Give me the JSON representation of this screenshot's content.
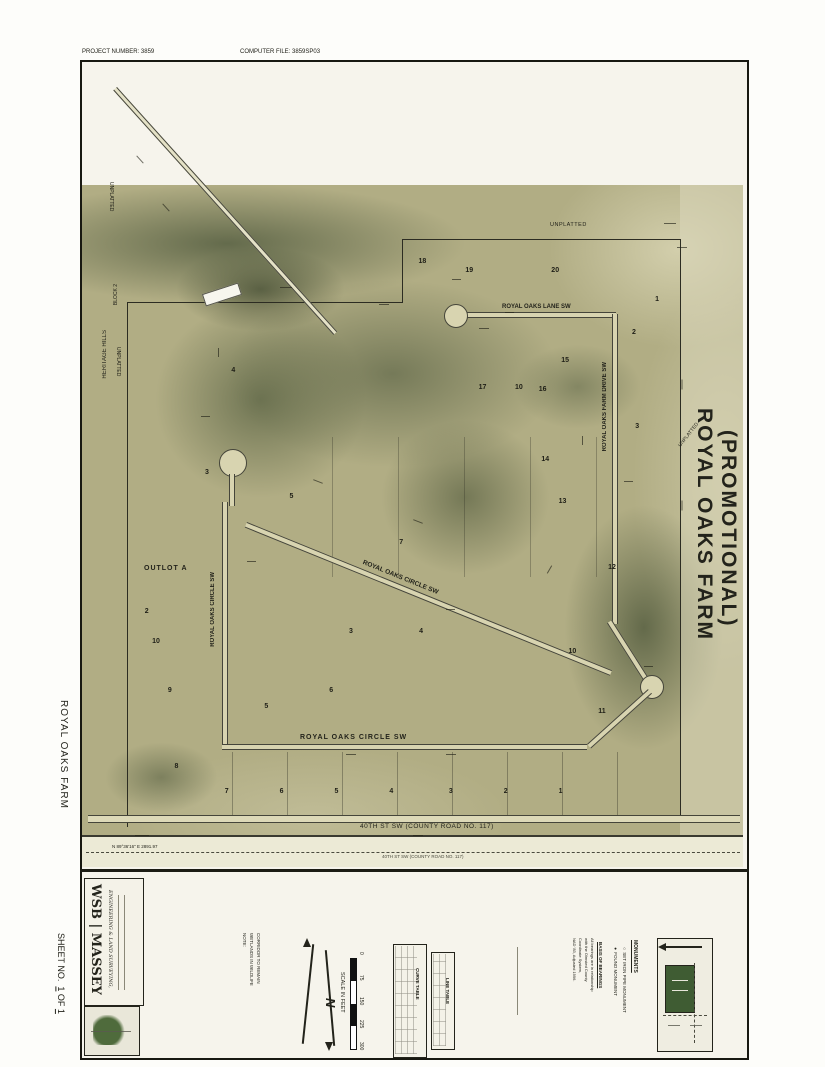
{
  "header": {
    "project_label": "PROJECT NUMBER",
    "project_value": "3859",
    "file_label": "COMPUTER FILE",
    "file_value": "3859SP03"
  },
  "titles": {
    "right_line1": "ROYAL OAKS FARM",
    "right_line2": "(PROMOTIONAL)",
    "left_margin": "ROYAL OAKS FARM",
    "sheet_label": "SHEET NO.",
    "sheet_num": "1",
    "sheet_of": "OF",
    "sheet_total": "1"
  },
  "firm": {
    "name": "WSB | MASSEY",
    "tagline": "ENGINEERING & LAND SURVEYING,"
  },
  "note": {
    "lines": [
      "NOTE:",
      "WETLANDS IN WILDLIFE",
      "CORRIDOR TO REMAIN"
    ]
  },
  "scale": {
    "label": "SCALE IN FEET",
    "ticks": [
      "0",
      "75",
      "150",
      "225",
      "300"
    ],
    "north_letter": "N"
  },
  "tables": {
    "curve_title": "CURVE TABLE",
    "line_title": "LINE TABLE"
  },
  "legend": {
    "title": "MONUMENTS",
    "items": [
      {
        "symbol": "○",
        "label": "SET IRON PIPE MONUMENT"
      },
      {
        "symbol": "●",
        "label": "FOUND MONUMENT"
      }
    ],
    "bearings_title": "BASIS OF BEARINGS",
    "bearings_lines": [
      "All bearings are in relationship",
      "with the Olmsted County",
      "Coordinate System,",
      "NAD '83, Adjusted 1996."
    ]
  },
  "map": {
    "streets": {
      "lane": "ROYAL OAKS LANE SW",
      "circle": "ROYAL OAKS CIRCLE SW",
      "farm_drive": "ROYAL OAKS FARM DRIVE SW",
      "county_road": "40TH ST SW (COUNTY ROAD NO. 117)"
    },
    "labels": {
      "outlot": "OUTLOT A",
      "unplatted": "UNPLATTED",
      "heritage": "HERITAGE HILLS",
      "block2": "BLOCK 2"
    },
    "bearing_bottom": "N 89°36'16\" E   2891.97",
    "lots": [
      {
        "n": "18",
        "x": 50.9,
        "y": 24.3
      },
      {
        "n": "19",
        "x": 58.0,
        "y": 25.5
      },
      {
        "n": "20",
        "x": 71.0,
        "y": 25.5
      },
      {
        "n": "1",
        "x": 86.7,
        "y": 29.1
      },
      {
        "n": "2",
        "x": 83.2,
        "y": 33.2
      },
      {
        "n": "15",
        "x": 72.5,
        "y": 36.6
      },
      {
        "n": "16",
        "x": 69.1,
        "y": 40.3
      },
      {
        "n": "10",
        "x": 65.5,
        "y": 40.0
      },
      {
        "n": "17",
        "x": 60.0,
        "y": 40.0
      },
      {
        "n": "3",
        "x": 83.7,
        "y": 44.9
      },
      {
        "n": "14",
        "x": 69.5,
        "y": 49.0
      },
      {
        "n": "4",
        "x": 22.6,
        "y": 37.9
      },
      {
        "n": "3",
        "x": 18.6,
        "y": 50.5
      },
      {
        "n": "5",
        "x": 31.4,
        "y": 53.6
      },
      {
        "n": "7",
        "x": 48.0,
        "y": 59.2
      },
      {
        "n": "13",
        "x": 72.1,
        "y": 54.2
      },
      {
        "n": "12",
        "x": 79.6,
        "y": 62.3
      },
      {
        "n": "2",
        "x": 9.5,
        "y": 67.8
      },
      {
        "n": "10",
        "x": 10.6,
        "y": 71.5
      },
      {
        "n": "3",
        "x": 40.4,
        "y": 70.3
      },
      {
        "n": "4",
        "x": 51.0,
        "y": 70.3
      },
      {
        "n": "6",
        "x": 37.4,
        "y": 77.7
      },
      {
        "n": "5",
        "x": 27.6,
        "y": 79.6
      },
      {
        "n": "10",
        "x": 73.6,
        "y": 72.8
      },
      {
        "n": "11",
        "x": 78.1,
        "y": 80.2
      },
      {
        "n": "9",
        "x": 13.0,
        "y": 77.7
      },
      {
        "n": "8",
        "x": 14.0,
        "y": 87.1
      },
      {
        "n": "7",
        "x": 21.6,
        "y": 90.2
      },
      {
        "n": "6",
        "x": 29.9,
        "y": 90.2
      },
      {
        "n": "5",
        "x": 38.2,
        "y": 90.2
      },
      {
        "n": "4",
        "x": 46.5,
        "y": 90.2
      },
      {
        "n": "3",
        "x": 55.5,
        "y": 90.2
      },
      {
        "n": "2",
        "x": 63.8,
        "y": 90.2
      },
      {
        "n": "1",
        "x": 72.1,
        "y": 90.2
      }
    ]
  }
}
